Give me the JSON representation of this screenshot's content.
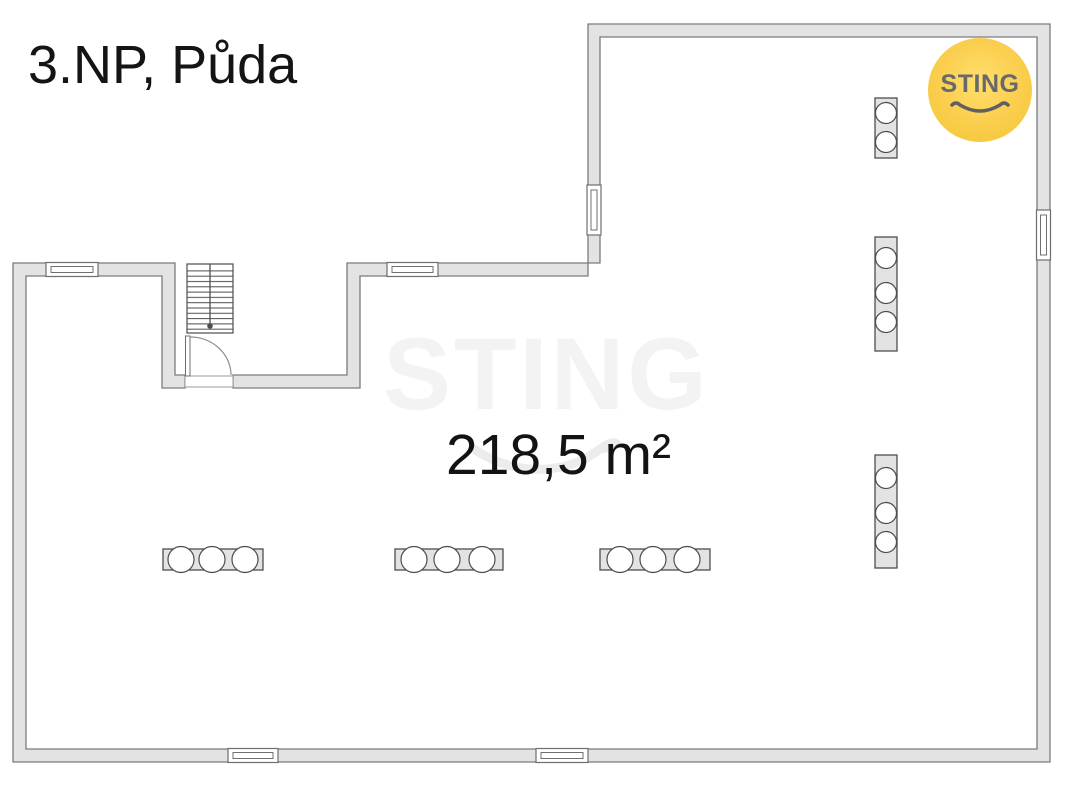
{
  "page": {
    "background_color": "#ffffff"
  },
  "floorplan": {
    "title": "3.NP, Půda",
    "area_label": "218,5 m²",
    "watermark_text": "STING",
    "colors": {
      "wall_fill": "#e3e3e3",
      "wall_stroke": "#7b7b7b",
      "symbol_stroke": "#4d4d4d",
      "text_color": "#141414",
      "watermark_color": "#f3f3f3"
    },
    "symbols": {
      "windows": 6,
      "radiators": 3,
      "chimney_flues": 3,
      "has_staircase": true,
      "has_door_swing": true
    }
  },
  "logo": {
    "text": "STING",
    "bg_color": "#f7c93d",
    "text_color": "#696969"
  }
}
